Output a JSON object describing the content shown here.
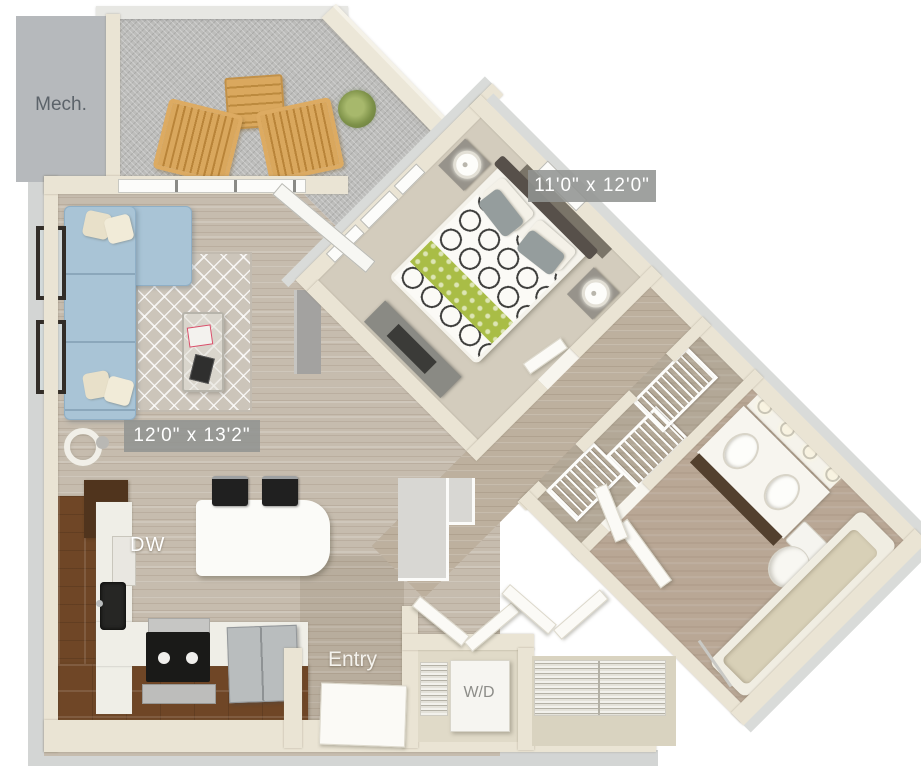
{
  "labels": {
    "mech": "Mech.",
    "dishwasher": "DW",
    "entry": "Entry",
    "washer_dryer": "W/D"
  },
  "dimension_badges": {
    "bedroom": "11'0\" x 12'0\"",
    "living_room": "12'0\" x 13'2\""
  },
  "colors": {
    "wall_cream": "#eae4d4",
    "slab_gray": "#d3d5d4",
    "mech_gray": "#b6b9bc",
    "wood_floor": "#c6bcae",
    "bedroom_carpet": "#d3ccbd",
    "patio_concrete": "#bdbdbb",
    "sofa_blue": "#a9c4d6",
    "cabinet_brown": "#6f4626",
    "counter_white": "#efeee7",
    "badge_gray": "#929492",
    "duvet_accent_green": "#a9bd46",
    "label_white": "#ffffff",
    "label_gray": "#5c636a"
  }
}
